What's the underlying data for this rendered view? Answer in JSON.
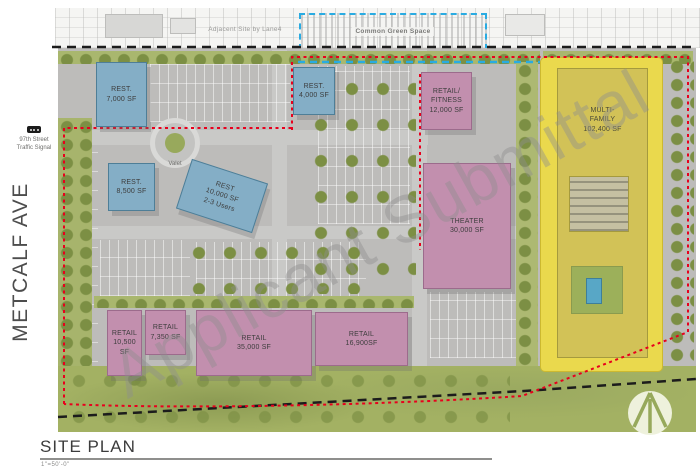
{
  "page": {
    "street_label": "METCALF AVE",
    "title": "SITE PLAN",
    "scale": "1\"=50'-0\"",
    "watermark": "Applicant Submittal"
  },
  "context": {
    "adjacent_site_label": "Adjacent Site by Lane4",
    "common_green_space_label": "Common Green Space",
    "traffic_signal_label": "97th Street\nTraffic Signal",
    "valet_label": "Valet"
  },
  "buildings": [
    {
      "id": "rest-7000",
      "type": "restaurant",
      "label": "REST.\n7,000 SF",
      "color": "#84aec6"
    },
    {
      "id": "rest-4000",
      "type": "restaurant",
      "label": "REST.\n4,000 SF",
      "color": "#84aec6"
    },
    {
      "id": "retail-fitness",
      "type": "retail",
      "label": "RETAIL/\nFITNESS\n12,000 SF",
      "color": "#c28fae"
    },
    {
      "id": "rest-8500",
      "type": "restaurant",
      "label": "REST.\n8,500 SF",
      "color": "#84aec6"
    },
    {
      "id": "rest-10000",
      "type": "restaurant",
      "label": "REST\n10,000 SF\n2-3 Users",
      "color": "#84aec6"
    },
    {
      "id": "theater",
      "type": "theater",
      "label": "THEATER\n30,000 SF",
      "color": "#c28fae"
    },
    {
      "id": "multi-family",
      "type": "residential",
      "label": "MULTI-\nFAMILY\n102,400 SF",
      "color": "#ead94d"
    },
    {
      "id": "retail-10500",
      "type": "retail",
      "label": "RETAIL\n10,500 SF",
      "color": "#c28fae"
    },
    {
      "id": "retail-7350",
      "type": "retail",
      "label": "RETAIL\n7,350 SF",
      "color": "#c28fae"
    },
    {
      "id": "retail-35000",
      "type": "retail",
      "label": "RETAIL\n35,000 SF",
      "color": "#c28fae"
    },
    {
      "id": "retail-16900",
      "type": "retail",
      "label": "RETAIL\n16,900SF",
      "color": "#c28fae"
    }
  ],
  "legend_colors": {
    "restaurant_blue": "#84aec6",
    "retail_pink": "#c28fae",
    "multifamily_yellow": "#ead94d",
    "boundary_red_dotted": "#e8001d",
    "boundary_black_dashed": "#1c1c1c",
    "green_space_blue_dashed": "#29abe2"
  }
}
